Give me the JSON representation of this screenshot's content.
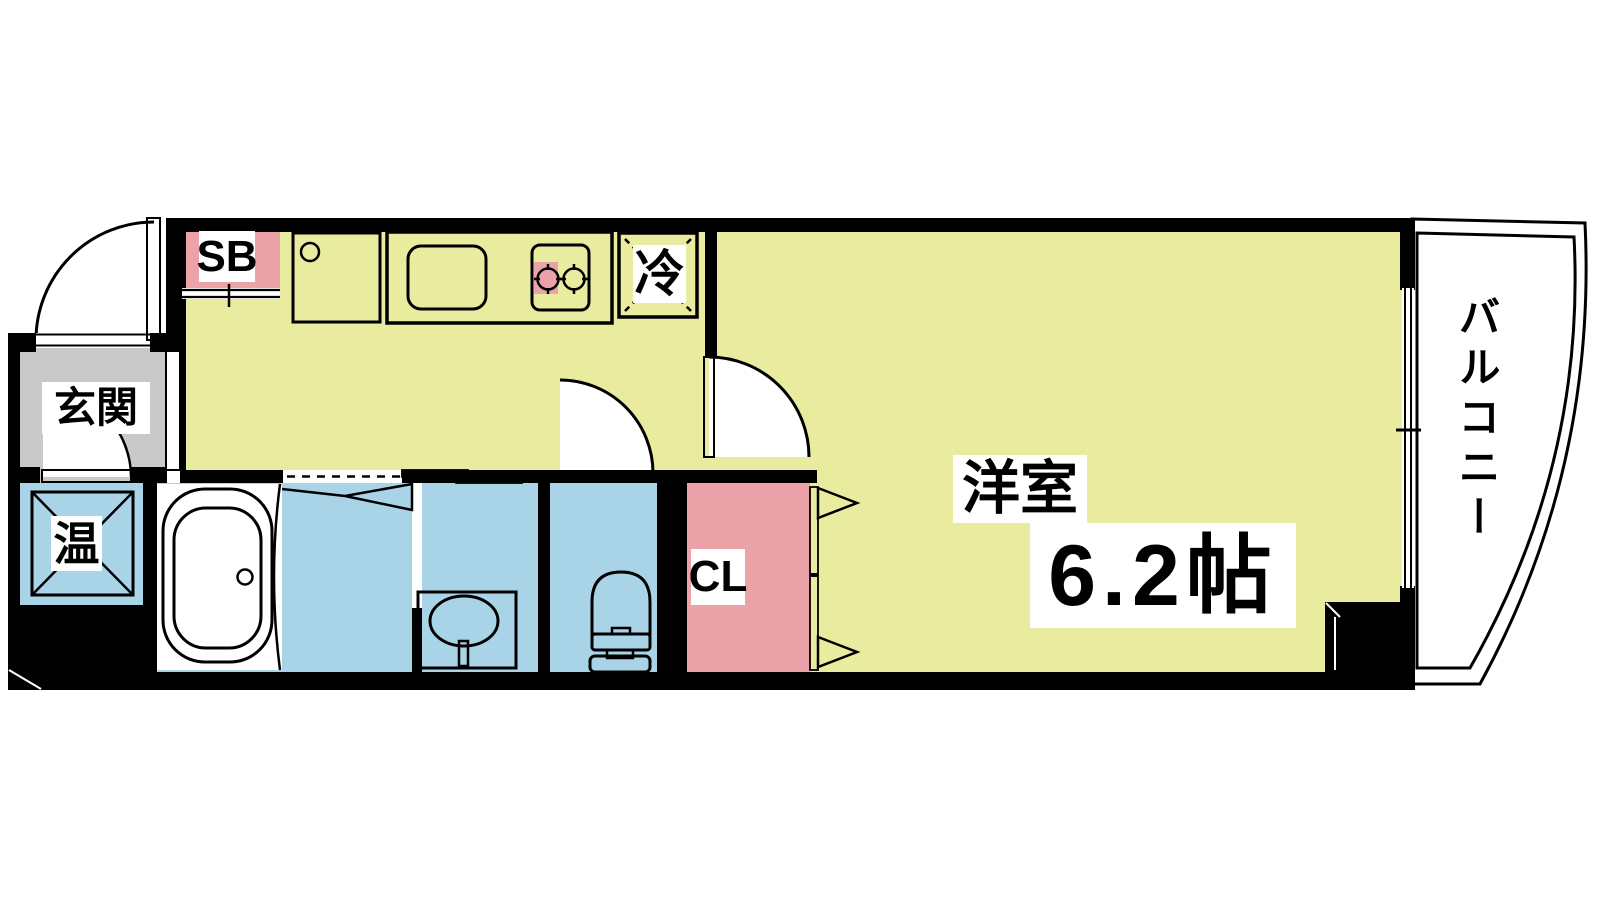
{
  "page": {
    "type": "apartment-floor-plan"
  },
  "labels": {
    "entrance": "玄関",
    "shoe_box": "SB",
    "refrigerator": "冷",
    "water_heater": "温",
    "closet": "CL",
    "western_room": "洋室",
    "western_room_size": "6.2帖",
    "balcony": "バルコニー"
  },
  "colors": {
    "room-yellow": "#e9ec9f",
    "wet-blue": "#a9d3e6",
    "accent-pink": "#eba3a9",
    "floor-gray": "#c9c9c9",
    "stove-gray": "#b6b6b6",
    "wall-black": "#000000"
  }
}
